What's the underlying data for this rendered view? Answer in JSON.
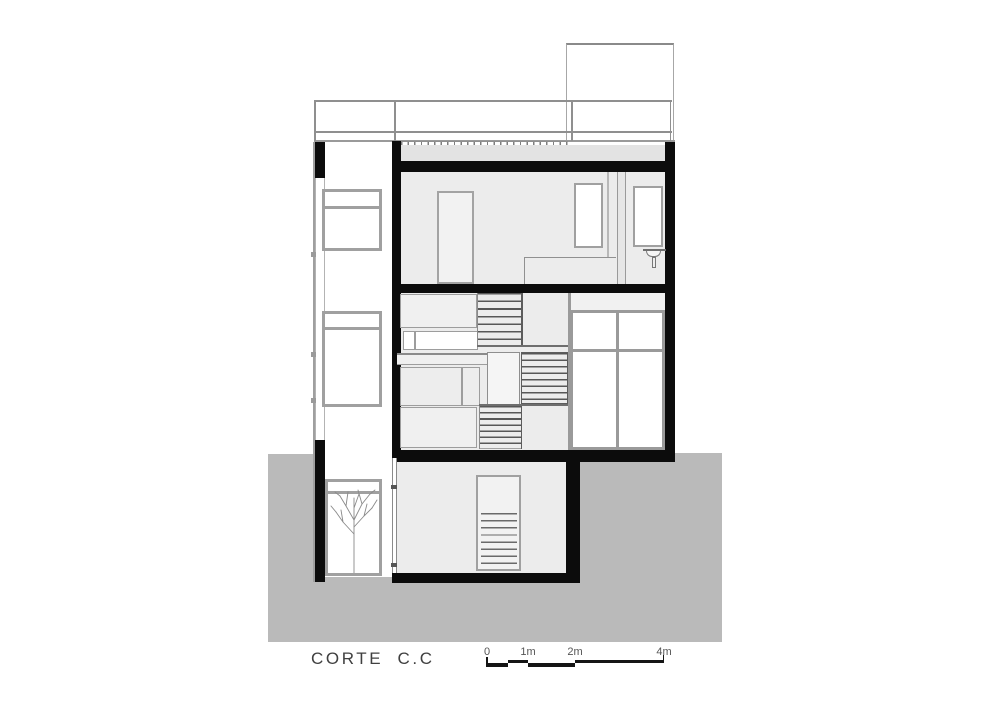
{
  "drawing": {
    "title": "CORTE C.C"
  },
  "scale_bar": {
    "labels": [
      "0",
      "1m",
      "2m",
      "4m"
    ]
  },
  "colors": {
    "wall": "#0c0c0c",
    "ground": "#bababa",
    "interior": "#ececec",
    "screed": "#e3e3e3",
    "frame": "#a0a0a0",
    "line": "#8f8f8f",
    "tread": "#575757",
    "text": "#404040"
  }
}
